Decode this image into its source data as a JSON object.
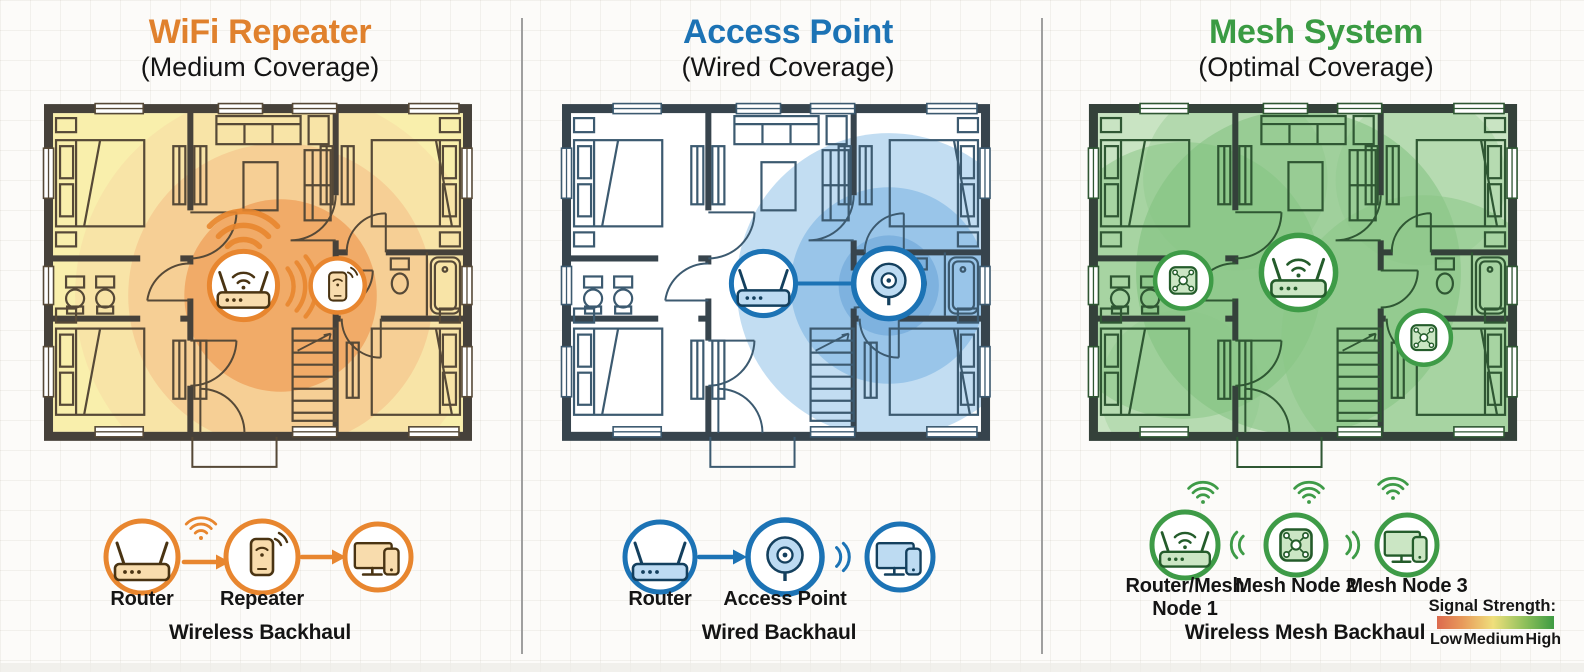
{
  "panels": [
    {
      "title": "WiFi Repeater",
      "subtitle": "(Medium Coverage)",
      "accent_color": "#E0812D",
      "coverage_colors": [
        "#EE9D57",
        "#F5C289",
        "#F6E98C"
      ],
      "legend": {
        "labels": [
          "Router",
          "Repeater"
        ],
        "backhaul": "Wireless Backhaul"
      }
    },
    {
      "title": "Access Point",
      "subtitle": "(Wired Coverage)",
      "accent_color": "#1C73B5",
      "coverage_colors": [
        "#79AEDD",
        "#92C1E7",
        "#B7D7F0"
      ],
      "legend": {
        "labels": [
          "Router",
          "Access Point"
        ],
        "backhaul": "Wired Backhaul"
      }
    },
    {
      "title": "Mesh System",
      "subtitle": "(Optimal Coverage)",
      "accent_color": "#3E9B47",
      "coverage_colors": [
        "#7EC07B",
        "#8AC687",
        "#C4E2BE"
      ],
      "legend": {
        "labels": [
          "Router/Mesh Node 1",
          "Mesh Node 2",
          "Mesh Node 3"
        ],
        "backhaul": "Wireless Mesh Backhaul"
      }
    }
  ],
  "signal_strength": {
    "title": "Signal Strength:",
    "levels": [
      "Low",
      "Medium",
      "High"
    ],
    "gradient_colors": [
      "#DC6A4E",
      "#EFDF7C",
      "#3E9B43"
    ]
  },
  "icons": [
    "router-icon",
    "router-wifi-icon",
    "repeater-icon",
    "access-point-icon",
    "mesh-node-icon",
    "devices-icon",
    "wifi-fan-icon",
    "wifi-waves-icon",
    "arrow-icon",
    "signal-gradient-bar"
  ]
}
